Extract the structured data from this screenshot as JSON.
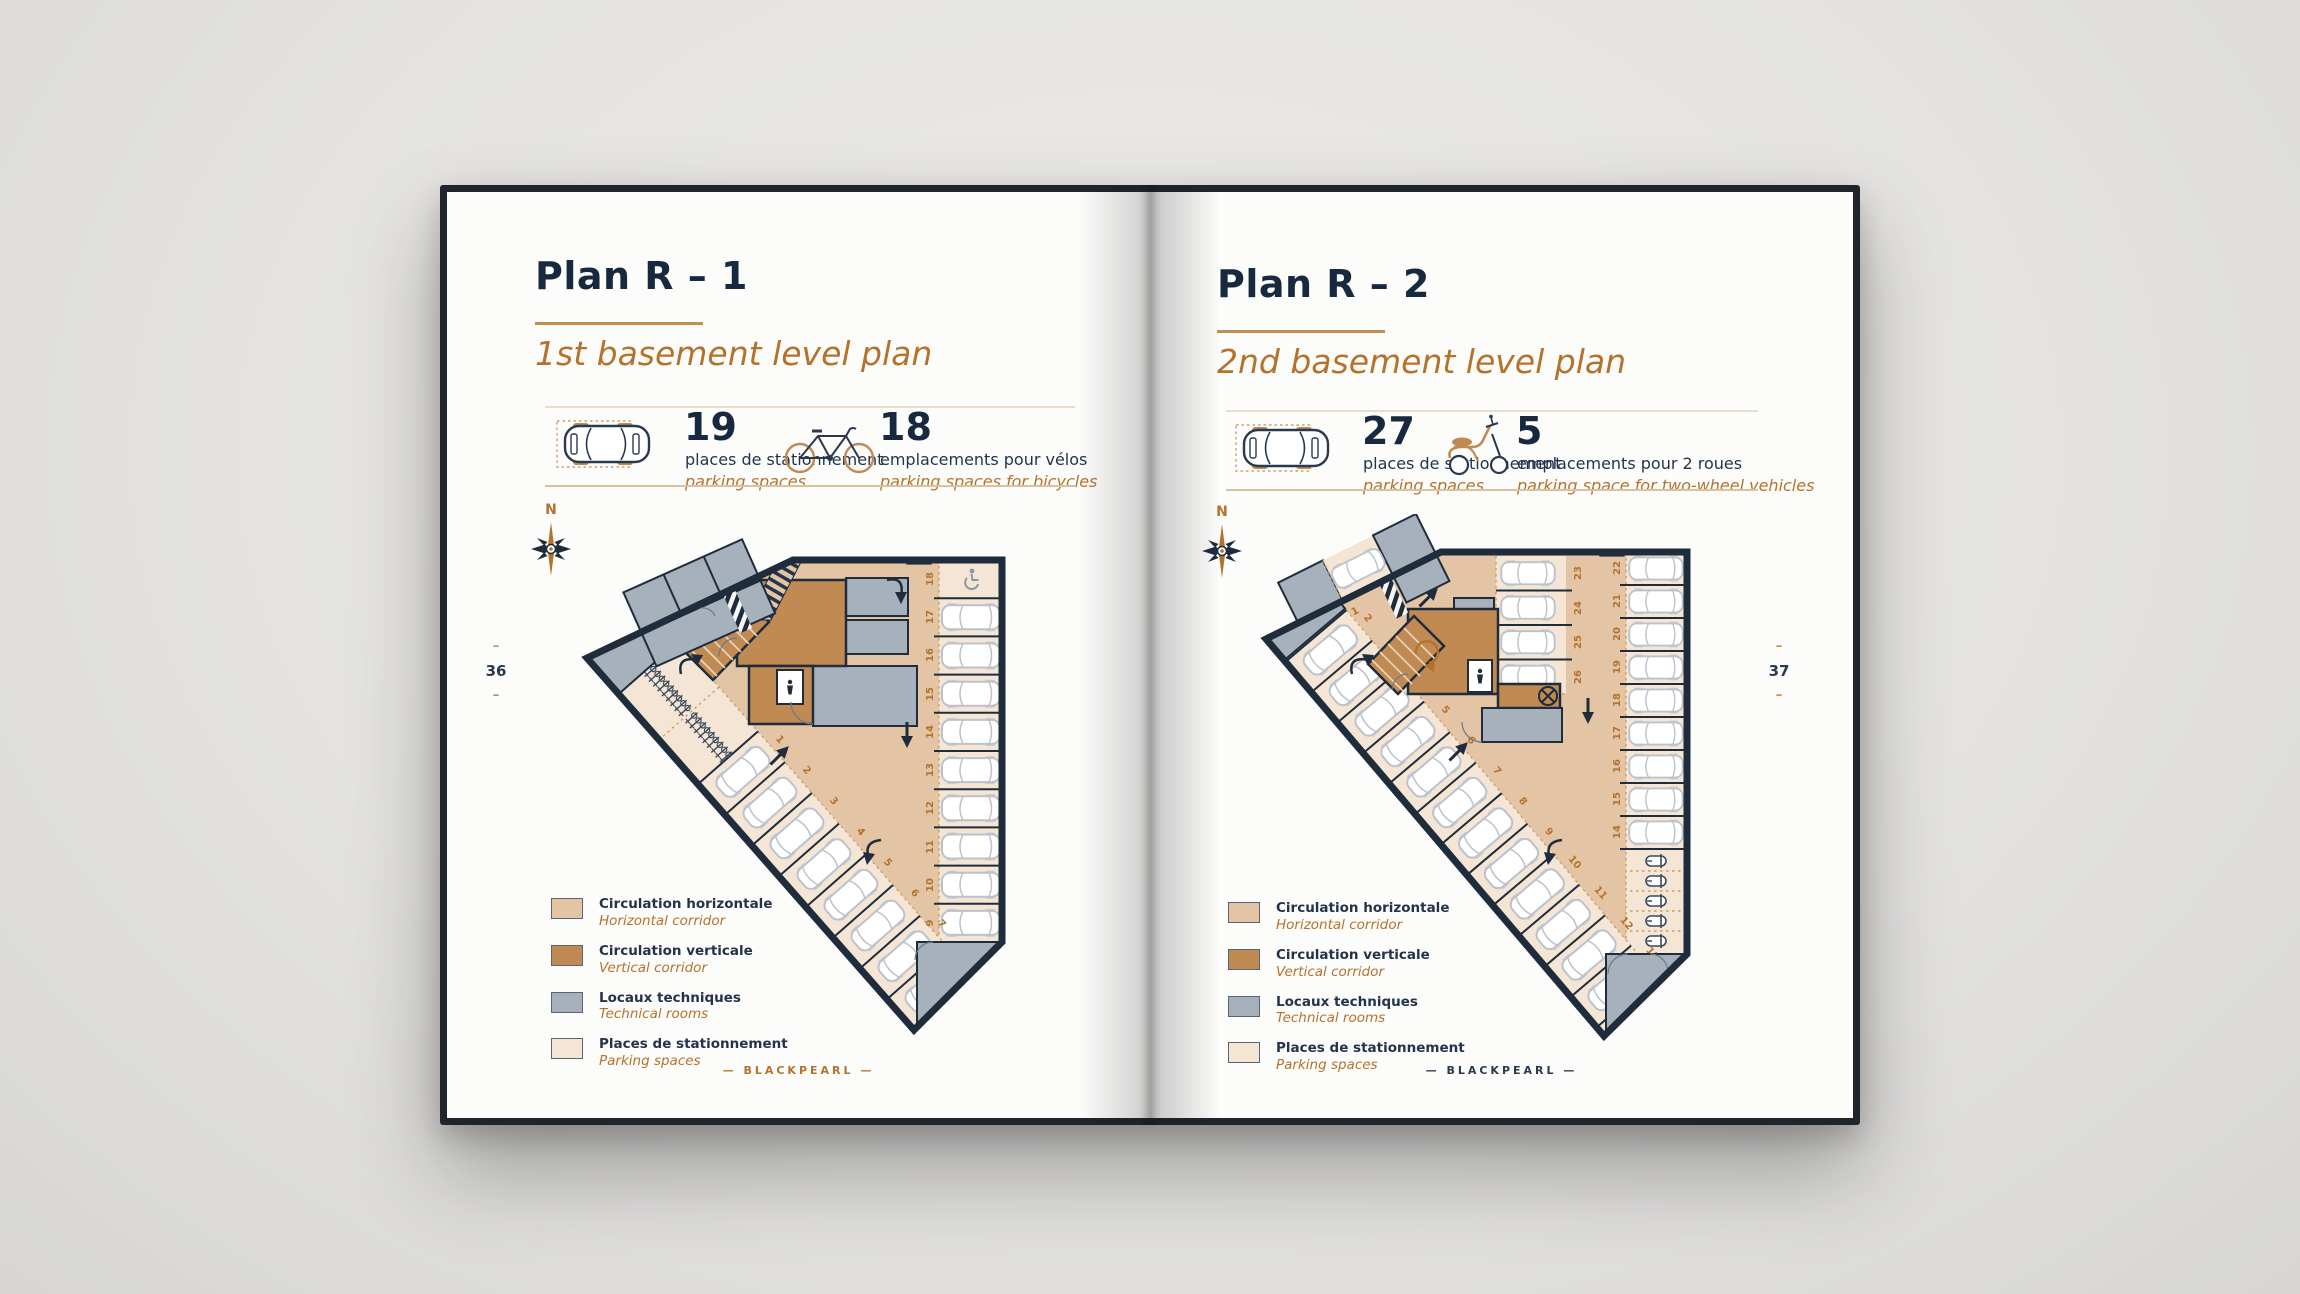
{
  "left_page": {
    "page_number": "36",
    "marker": "–",
    "title": "Plan R – 1",
    "subtitle": "1st basement level plan",
    "compass_label": "N",
    "footer": "— BLACKPEARL —",
    "stats": [
      {
        "icon": "car-top-icon",
        "value": "19",
        "label_fr": "places de stationnement",
        "label_en": "parking spaces"
      },
      {
        "icon": "bicycle-icon",
        "value": "18",
        "label_fr": "emplacements pour vélos",
        "label_en": "parking spaces for bicycles"
      }
    ],
    "plan": {
      "right_stalls": [
        "18",
        "17",
        "16",
        "15",
        "14",
        "13",
        "12",
        "11",
        "10",
        "9"
      ],
      "diagonal_stalls": [
        "1",
        "2",
        "3",
        "4",
        "5",
        "6",
        "7",
        "8"
      ]
    }
  },
  "right_page": {
    "page_number": "37",
    "marker": "–",
    "title": "Plan R – 2",
    "subtitle": "2nd basement level plan",
    "compass_label": "N",
    "footer": "— BLACKPEARL —",
    "stats": [
      {
        "icon": "car-top-icon",
        "value": "27",
        "label_fr": "places de stationnement",
        "label_en": "parking spaces"
      },
      {
        "icon": "scooter-icon",
        "value": "5",
        "label_fr": "emplacements pour 2 roues",
        "label_en": "parking space for two-wheel vehicles"
      }
    ],
    "plan": {
      "annex_stall": "1",
      "left_stalls": [
        "2",
        "3",
        "4",
        "5",
        "6",
        "7",
        "8",
        "9",
        "10",
        "11",
        "12",
        "13"
      ],
      "center_stalls": [
        "23",
        "24",
        "25",
        "26"
      ],
      "right_stalls": [
        "22",
        "21",
        "20",
        "19",
        "18",
        "17",
        "16",
        "15",
        "14"
      ]
    }
  },
  "legend": {
    "items": [
      {
        "swatch_color": "#e3c4a5",
        "label_fr": "Circulation horizontale",
        "label_en": "Horizontal corridor"
      },
      {
        "swatch_color": "#c08a52",
        "label_fr": "Circulation verticale",
        "label_en": "Vertical corridor"
      },
      {
        "swatch_color": "#a7b1bc",
        "label_fr": "Locaux techniques",
        "label_en": "Technical rooms"
      },
      {
        "swatch_color": "#f4e5d5",
        "label_fr": "Places de stationnement",
        "label_en": "Parking spaces"
      }
    ]
  },
  "colors": {
    "navy": "#16293e",
    "accent_tan": "#b5722c",
    "underline_gold": "#c1904f",
    "circulation_beige": "#e3c4a5",
    "vertical_brown": "#c08a52",
    "technical_gray": "#a7b1bc",
    "stall_beige": "#f4e5d5",
    "paper": "#fcfcfb",
    "cover": "#20242c"
  }
}
